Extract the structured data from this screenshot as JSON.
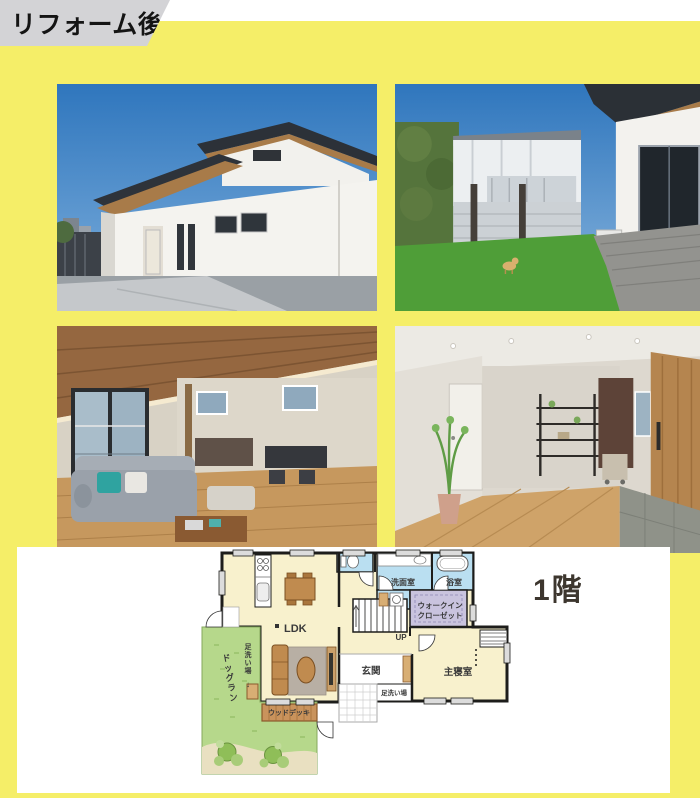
{
  "badge": {
    "label": "リフォーム後"
  },
  "colors": {
    "background": "#f5ee68",
    "badge_bg": "#d3d3d6",
    "badge_text": "#141414",
    "panel_bg": "#ffffff",
    "plan_room": "#f8f1cd",
    "plan_wet": "#badff1",
    "plan_closet": "#c9c3de",
    "plan_garden": "#b6d88b",
    "plan_deck": "#c9935c",
    "plan_wall": "#1d1d1b"
  },
  "photos": [
    {
      "id": "exterior-front"
    },
    {
      "id": "backyard-dog-run"
    },
    {
      "id": "ldk-interior"
    },
    {
      "id": "entrance-hall"
    }
  ],
  "floor_plan": {
    "title": "1階",
    "labels": {
      "ldk": "LDK",
      "washroom": "洗面室",
      "bathroom": "浴室",
      "wic_line1": "ウォークイン",
      "wic_line2": "クローゼット",
      "up": "UP",
      "entrance": "玄関",
      "master_bedroom": "主寝室",
      "footwash_left": "足洗い場",
      "footwash_left_arrow": "↓",
      "footwash_bottom": "足洗い場",
      "dog_run": "ドッグラン",
      "wood_deck": "ウッドデッキ"
    }
  }
}
